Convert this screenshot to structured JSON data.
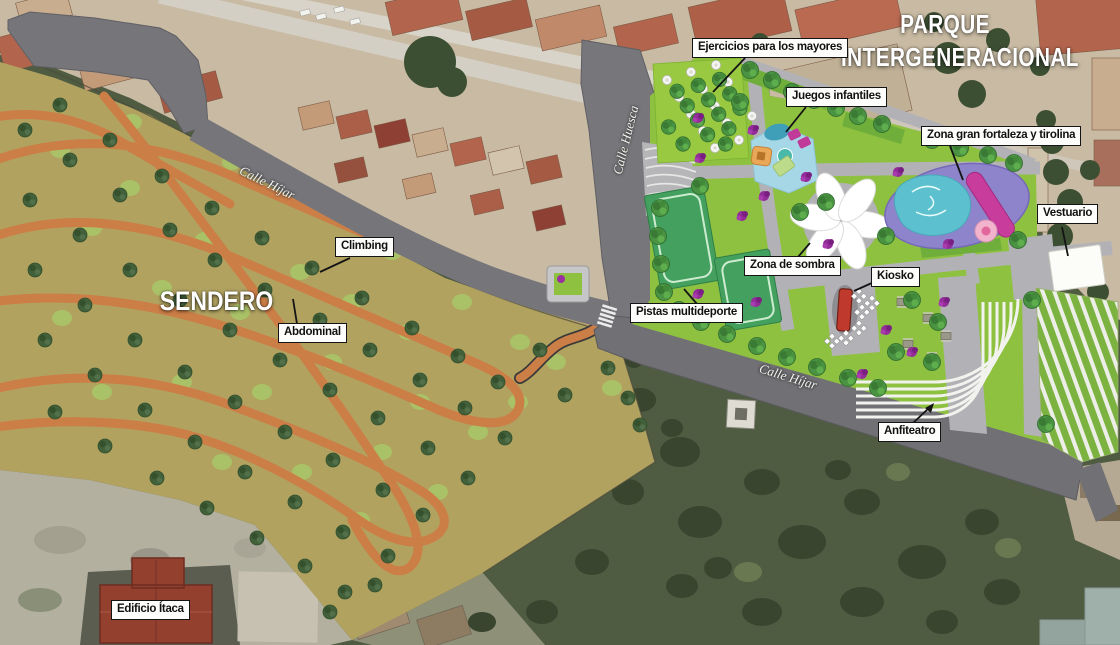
{
  "map": {
    "title_line1": "PARQUE",
    "title_line2": "INTERGENERACIONAL",
    "zone_label": "SENDERO"
  },
  "streets": {
    "huesca": "Calle Huesca",
    "hijar_west": "Calle Híjar",
    "hijar_south": "Calle Híjar"
  },
  "annotations": [
    {
      "id": "ejercicios",
      "text": "Ejercicios para los mayores"
    },
    {
      "id": "juegos",
      "text": "Juegos infantiles"
    },
    {
      "id": "fortaleza",
      "text": "Zona gran fortaleza y tirolina"
    },
    {
      "id": "vestuario",
      "text": "Vestuario"
    },
    {
      "id": "sombra",
      "text": "Zona de sombra"
    },
    {
      "id": "kiosko",
      "text": "Kiosko"
    },
    {
      "id": "pistas",
      "text": "Pistas multideporte"
    },
    {
      "id": "anfiteatro",
      "text": "Anfiteatro"
    },
    {
      "id": "climbing",
      "text": "Climbing"
    },
    {
      "id": "abdominal",
      "text": "Abdominal"
    },
    {
      "id": "edificio",
      "text": "Edificio Ítaca"
    }
  ],
  "colors": {
    "park_grass": "#8fc140",
    "path_gray": "#b2b2b6",
    "road_gray": "#75757a",
    "sendero_tan": "#b1a260",
    "trail_orange": "#cc7e47",
    "playground_blue": "#a5d7e6",
    "fortress_violet": "#8d84cb",
    "zipline_magenta": "#c83c9c",
    "court_green": "#44a05e",
    "kiosk_red": "#bf3a2c",
    "bush_purple": "#932b99"
  }
}
